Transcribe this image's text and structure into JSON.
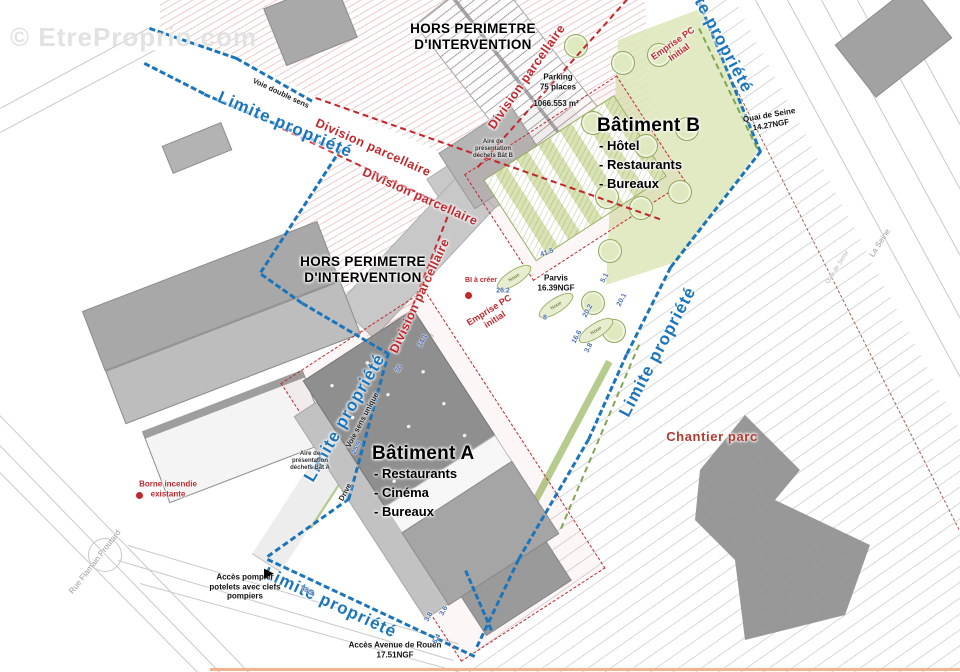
{
  "watermark": "© EtreProprio.com",
  "colors": {
    "boundary_blue": "#1b75bc",
    "division_red": "#c1272d",
    "seine_line": "#a2604f",
    "dimension_blue": "#4a6fb5",
    "green_fill": "#dce6b8",
    "building_gray": "#8f8f8f",
    "chantier_red": "#b03a30"
  },
  "batiments": {
    "a": {
      "title": "Bâtiment A",
      "items": [
        "- Restaurants",
        "- Cinéma",
        "- Bureaux"
      ]
    },
    "b": {
      "title": "Bâtiment B",
      "items": [
        "- Hôtel",
        "- Restaurants",
        "- Bureaux"
      ]
    }
  },
  "labels": [
    {
      "name": "limite-propriete-label",
      "text": "Limite propriété",
      "x": 285,
      "y": 125,
      "rot": 23,
      "cls": "lp"
    },
    {
      "name": "limite-propriete-label",
      "text": "Limite propriété",
      "x": 658,
      "y": 352,
      "rot": -62,
      "cls": "lp"
    },
    {
      "name": "limite-propriete-label",
      "text": "Limite propriété",
      "x": 345,
      "y": 418,
      "rot": -60,
      "cls": "lp"
    },
    {
      "name": "limite-propriete-label",
      "text": "Limite propriété",
      "x": 330,
      "y": 603,
      "rot": 25,
      "cls": "lp"
    },
    {
      "name": "limite-propriete-label",
      "text": "Limite propriété",
      "x": 714,
      "y": 28,
      "rot": 62,
      "cls": "lp"
    },
    {
      "name": "division-parcellaire-label",
      "text": "Division parcellaire",
      "x": 527,
      "y": 77,
      "rot": -55,
      "cls": "dp"
    },
    {
      "name": "division-parcellaire-label",
      "text": "Division parcellaire",
      "x": 373,
      "y": 148,
      "rot": 24,
      "cls": "dp"
    },
    {
      "name": "division-parcellaire-label",
      "text": "Division parcellaire",
      "x": 420,
      "y": 197,
      "rot": 24,
      "cls": "dp"
    },
    {
      "name": "division-parcellaire-label",
      "text": "Division parcellaire",
      "x": 420,
      "y": 296,
      "rot": -65,
      "cls": "dp"
    },
    {
      "name": "hors-perimetre-label",
      "text": "HORS PERIMETRE\nD'INTERVENTION",
      "x": 473,
      "y": 37,
      "rot": 0,
      "cls": "hors"
    },
    {
      "name": "hors-perimetre-label",
      "text": "HORS PERIMETRE\nD'INTERVENTION",
      "x": 363,
      "y": 270,
      "rot": 0,
      "cls": "hors"
    },
    {
      "name": "parking-label",
      "text": "Parking\n75 places",
      "x": 558,
      "y": 82,
      "rot": 0,
      "cls": "small-bold"
    },
    {
      "name": "parking-area-label",
      "text": "1066.553 m²",
      "x": 556,
      "y": 104,
      "rot": 0,
      "cls": "small-bold"
    },
    {
      "name": "parvis-label",
      "text": "Parvis\n16.39NGF",
      "x": 556,
      "y": 283,
      "rot": 0,
      "cls": "small-bold"
    },
    {
      "name": "quai-de-seine-label",
      "text": "Quai de Seine\n14.27NGF",
      "x": 770,
      "y": 120,
      "rot": -10,
      "cls": "small-bold"
    },
    {
      "name": "acces-avenue-label",
      "text": "Accès Avenue de Rouen\n17.51NGF",
      "x": 395,
      "y": 650,
      "rot": 0,
      "cls": "small-bold"
    },
    {
      "name": "acces-pompier-label",
      "text": "Accès pompier\npotelets avec clefs\npompiers",
      "x": 245,
      "y": 587,
      "rot": 0,
      "cls": "small-bold"
    },
    {
      "name": "borne-incendie-label",
      "text": "Borne incendie\nexistante",
      "x": 168,
      "y": 489,
      "rot": 0,
      "cls": "small-red"
    },
    {
      "name": "bi-a-creer-label",
      "text": "BI à créer",
      "x": 481,
      "y": 281,
      "rot": 0,
      "cls": "tiny-red"
    },
    {
      "name": "emprise-pc-label",
      "text": "Emprise PC\nInitial",
      "x": 676,
      "y": 48,
      "rot": -35,
      "cls": "emprise"
    },
    {
      "name": "emprise-pc-label",
      "text": "Emprise PC\ninitial",
      "x": 492,
      "y": 315,
      "rot": -32,
      "cls": "emprise"
    },
    {
      "name": "chantier-parc-label",
      "text": "Chantier parc",
      "x": 712,
      "y": 437,
      "rot": 0,
      "cls": "chantier"
    },
    {
      "name": "voie-double-sens-label",
      "text": "Voie double sens",
      "x": 281,
      "y": 93,
      "rot": 25,
      "cls": "tiny-black"
    },
    {
      "name": "voie-sens-unique-label",
      "text": "Voie sens unique",
      "x": 362,
      "y": 420,
      "rot": -62,
      "cls": "tiny-black"
    },
    {
      "name": "drive-label",
      "text": "Drive",
      "x": 345,
      "y": 492,
      "rot": -62,
      "cls": "tiny-black"
    },
    {
      "name": "aire-dechets-a-label",
      "text": "Aire de\nprésentation\ndéchets Bât A",
      "x": 310,
      "y": 462,
      "rot": 0,
      "cls": "micro"
    },
    {
      "name": "aire-dechets-b-label",
      "text": "Aire de\nprésentation\ndéchets Bât B",
      "x": 493,
      "y": 150,
      "rot": 0,
      "cls": "micro"
    },
    {
      "name": "la-seine-label",
      "text": "La Seine",
      "x": 880,
      "y": 243,
      "rot": -57,
      "cls": "tiny-gray"
    },
    {
      "name": "quai-road-label",
      "text": "Quai de Seine",
      "x": 838,
      "y": 268,
      "rot": -57,
      "cls": "micro-gray"
    },
    {
      "name": "rue-label",
      "text": "Rue Flamain Proutard",
      "x": 95,
      "y": 562,
      "rot": -52,
      "cls": "tiny-gray"
    }
  ],
  "lines": [
    {
      "name": "limite-propriete-line",
      "cls": "blue",
      "x": 150,
      "y": 27,
      "len": 92,
      "rot": 19
    },
    {
      "name": "limite-propriete-line",
      "cls": "blue",
      "x": 237,
      "y": 57,
      "len": 87,
      "rot": 29.5
    },
    {
      "name": "limite-propriete-line",
      "cls": "blue",
      "x": 145,
      "y": 62,
      "len": 67,
      "rot": 27
    },
    {
      "name": "limite-propriete-line",
      "cls": "blue",
      "x": 205,
      "y": 93,
      "len": 148,
      "rot": 22.6
    },
    {
      "name": "limite-propriete-line",
      "cls": "blue",
      "x": 342,
      "y": 150,
      "len": 147,
      "rot": 123
    },
    {
      "name": "limite-propriete-line",
      "cls": "blue",
      "x": 262,
      "y": 273,
      "len": 50,
      "rot": 35.3
    },
    {
      "name": "limite-propriete-line",
      "cls": "blue",
      "x": 303,
      "y": 302,
      "len": 101,
      "rot": 30.4
    },
    {
      "name": "limite-propriete-line",
      "cls": "blue",
      "x": 390,
      "y": 353,
      "len": 152,
      "rot": 105.2
    },
    {
      "name": "limite-propriete-line",
      "cls": "blue",
      "x": 350,
      "y": 500,
      "len": 100,
      "rot": 144.7
    },
    {
      "name": "limite-propriete-line",
      "cls": "blue",
      "x": 268,
      "y": 558,
      "len": 229,
      "rot": 25.1
    },
    {
      "name": "limite-propriete-line",
      "cls": "blue",
      "x": 700,
      "y": 0,
      "len": 164,
      "rot": 67.8
    },
    {
      "name": "limite-propriete-line",
      "cls": "blue",
      "x": 762,
      "y": 152,
      "len": 147,
      "rot": 127.8
    },
    {
      "name": "limite-propriete-line",
      "cls": "blue",
      "x": 672,
      "y": 268,
      "len": 97,
      "rot": 116.8
    },
    {
      "name": "limite-propriete-line",
      "cls": "blue",
      "x": 628,
      "y": 355,
      "len": 93,
      "rot": 114.1
    },
    {
      "name": "limite-propriete-line",
      "cls": "blue",
      "x": 590,
      "y": 440,
      "len": 139,
      "rot": 120.3
    },
    {
      "name": "limite-propriete-line",
      "cls": "blue",
      "x": 520,
      "y": 560,
      "len": 97,
      "rot": 115.5
    },
    {
      "name": "limite-propriete-line",
      "cls": "blue",
      "x": 467,
      "y": 570,
      "len": 65,
      "rot": 66.6
    },
    {
      "name": "division-parcellaire-line",
      "cls": "red",
      "x": 628,
      "y": 0,
      "len": 225,
      "rot": 131.7
    },
    {
      "name": "division-parcellaire-line",
      "cls": "red",
      "x": 316,
      "y": 97,
      "len": 365,
      "rot": 19.4
    },
    {
      "name": "division-parcellaire-line",
      "cls": "red",
      "x": 283,
      "y": 128,
      "len": 187,
      "rot": 25.3
    },
    {
      "name": "division-parcellaire-line",
      "cls": "red",
      "x": 452,
      "y": 208,
      "len": 155,
      "rot": 111.3
    },
    {
      "name": "seine-bank-line",
      "cls": "seine",
      "x": 735,
      "y": 85,
      "len": 498,
      "rot": 63.2
    },
    {
      "name": "green-strip-line",
      "cls": "green",
      "x": 700,
      "y": 28,
      "len": 133,
      "rot": 64.2
    },
    {
      "name": "green-strip-line",
      "cls": "green",
      "x": 640,
      "y": 345,
      "len": 200,
      "rot": 113
    },
    {
      "name": "road-line",
      "cls": "road",
      "x": 0,
      "y": 108,
      "len": 170,
      "rot": -28.4
    },
    {
      "name": "road-line",
      "cls": "road",
      "x": 0,
      "y": 132,
      "len": 175,
      "rot": -28
    },
    {
      "name": "road-line",
      "cls": "road",
      "x": 0,
      "y": 415,
      "len": 358,
      "rot": 45.9
    },
    {
      "name": "road-line",
      "cls": "road",
      "x": 0,
      "y": 445,
      "len": 320,
      "rot": 45.9
    },
    {
      "name": "road-line",
      "cls": "road",
      "x": 0,
      "y": 472,
      "len": 281,
      "rot": 45.3
    },
    {
      "name": "road-line",
      "cls": "road",
      "x": 118,
      "y": 560,
      "len": 350,
      "rot": 16.6
    },
    {
      "name": "road-line",
      "cls": "road",
      "x": 128,
      "y": 545,
      "len": 345,
      "rot": 16.6
    },
    {
      "name": "road-line",
      "cls": "road",
      "x": 140,
      "y": 583,
      "len": 332,
      "rot": 15.5
    },
    {
      "name": "quai-road-line",
      "cls": "road",
      "x": 756,
      "y": 0,
      "len": 429,
      "rot": 61.5
    },
    {
      "name": "quai-road-line",
      "cls": "road",
      "x": 788,
      "y": 0,
      "len": 390,
      "rot": 61.5
    },
    {
      "name": "quai-road-line",
      "cls": "road",
      "x": 822,
      "y": 0,
      "len": 350,
      "rot": 61.5
    },
    {
      "name": "quai-road-line",
      "cls": "road",
      "x": 858,
      "y": 0,
      "len": 300,
      "rot": 61.5
    },
    {
      "name": "quai-road-line",
      "cls": "road",
      "x": 893,
      "y": 0,
      "len": 250,
      "rot": 61.5
    },
    {
      "name": "bottom-edge-line",
      "cls": "orange",
      "x": 210,
      "y": 668,
      "len": 750,
      "rot": 0
    }
  ],
  "dims": [
    {
      "v": "41.5",
      "x": 547,
      "y": 253,
      "rot": -20
    },
    {
      "v": "5.1",
      "x": 605,
      "y": 278,
      "rot": -62
    },
    {
      "v": "20.1",
      "x": 622,
      "y": 300,
      "rot": -62
    },
    {
      "v": "26.2",
      "x": 503,
      "y": 291,
      "rot": 0
    },
    {
      "v": "20.2",
      "x": 588,
      "y": 311,
      "rot": -62
    },
    {
      "v": "16.6",
      "x": 577,
      "y": 337,
      "rot": -62
    },
    {
      "v": "3.8",
      "x": 589,
      "y": 348,
      "rot": -62
    },
    {
      "v": "8",
      "x": 545,
      "y": 318,
      "rot": 0
    },
    {
      "v": "34.1",
      "x": 423,
      "y": 341,
      "rot": -62
    },
    {
      "v": "36",
      "x": 399,
      "y": 369,
      "rot": -62
    },
    {
      "v": "25.9",
      "x": 357,
      "y": 448,
      "rot": -62
    },
    {
      "v": "38.9",
      "x": 307,
      "y": 591,
      "rot": 25
    },
    {
      "v": "3.8",
      "x": 429,
      "y": 617,
      "rot": -62
    },
    {
      "v": "3.6",
      "x": 444,
      "y": 611,
      "rot": -62
    },
    {
      "v": "6.4",
      "x": 437,
      "y": 639,
      "rot": -62
    }
  ],
  "trees": [
    {
      "x": 622,
      "y": 62
    },
    {
      "x": 658,
      "y": 54
    },
    {
      "x": 645,
      "y": 145
    },
    {
      "x": 686,
      "y": 128
    },
    {
      "x": 640,
      "y": 207
    },
    {
      "x": 679,
      "y": 191
    },
    {
      "x": 609,
      "y": 250
    },
    {
      "x": 592,
      "y": 302
    },
    {
      "x": 613,
      "y": 330
    },
    {
      "x": 575,
      "y": 45
    },
    {
      "x": 592,
      "y": 122
    },
    {
      "x": 606,
      "y": 196
    }
  ],
  "noues": [
    {
      "label": "Noue",
      "x": 513,
      "y": 277,
      "rot": -33
    },
    {
      "label": "Noue",
      "x": 555,
      "y": 305,
      "rot": -33
    },
    {
      "label": "Noue",
      "x": 595,
      "y": 330,
      "rot": -33
    }
  ],
  "markers": [
    {
      "type": "dot",
      "name": "borne-incendie-dot",
      "x": 136,
      "y": 492
    },
    {
      "type": "dot",
      "name": "bi-a-creer-dot",
      "x": 465,
      "y": 292
    },
    {
      "type": "tri",
      "name": "acces-pompier-arrow",
      "x": 264,
      "y": 566,
      "glyph": "▶"
    }
  ]
}
